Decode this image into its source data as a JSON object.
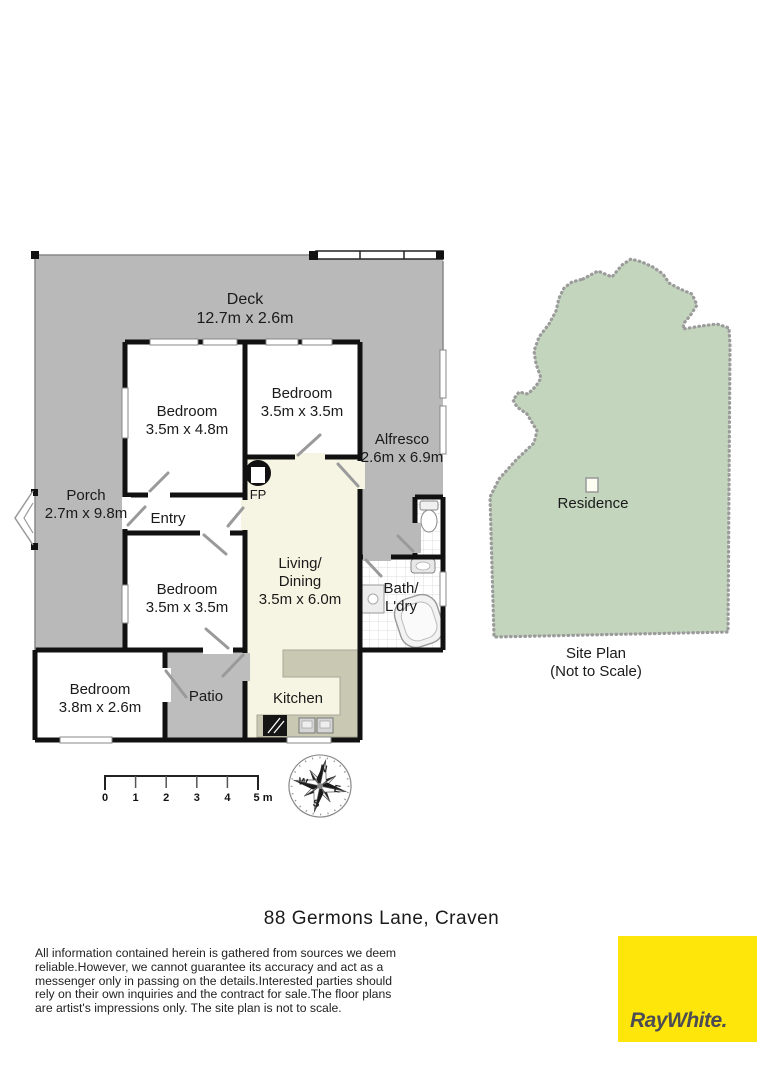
{
  "colors": {
    "deck_gray": "#b9b9b9",
    "patio_gray": "#bdbdbd",
    "floor_cream": "#f6f5e3",
    "counter_taupe": "#c9c8b2",
    "wall_black": "#111111",
    "site_green": "#c3d5bd",
    "logo_yellow": "#ffe60a",
    "logo_text": "#4c4c54"
  },
  "floor_plan": {
    "deck": {
      "name": "Deck",
      "dims": "12.7m x 2.6m"
    },
    "porch": {
      "name": "Porch",
      "dims": "2.7m x 9.8m"
    },
    "bedroom_top_left": {
      "name": "Bedroom",
      "dims": "3.5m x 4.8m"
    },
    "bedroom_top_right": {
      "name": "Bedroom",
      "dims": "3.5m x 3.5m"
    },
    "alfresco": {
      "name": "Alfresco",
      "dims": "2.6m x 6.9m"
    },
    "entry": {
      "name": "Entry"
    },
    "fireplace": {
      "label": "FP"
    },
    "living_dining": {
      "line1": "Living/",
      "line2": "Dining",
      "dims": "3.5m x 6.0m"
    },
    "bedroom_middle": {
      "name": "Bedroom",
      "dims": "3.5m x 3.5m"
    },
    "bath_laundry": {
      "line1": "Bath/",
      "line2": "L'dry"
    },
    "bedroom_bottom_left": {
      "name": "Bedroom",
      "dims": "3.8m x 2.6m"
    },
    "patio": {
      "name": "Patio"
    },
    "kitchen": {
      "name": "Kitchen"
    }
  },
  "site_plan": {
    "residence": "Residence",
    "caption1": "Site Plan",
    "caption2": "(Not to Scale)"
  },
  "scale_bar": {
    "labels": [
      "0",
      "1",
      "2",
      "3",
      "4",
      "5 m"
    ]
  },
  "compass": {
    "north": "N",
    "east": "E",
    "south": "S",
    "west": "W"
  },
  "address": "88 Germons Lane, Craven",
  "disclaimer": [
    "All information contained herein is gathered from sources we deem",
    "reliable.However, we cannot guarantee its accuracy and act as a",
    "messenger only in passing on the details.Interested parties should",
    "rely on their own inquiries and the contract for sale.The floor plans",
    "are artist's impressions only. The site plan is not to scale."
  ],
  "logo": {
    "brand": "RayWhite."
  }
}
